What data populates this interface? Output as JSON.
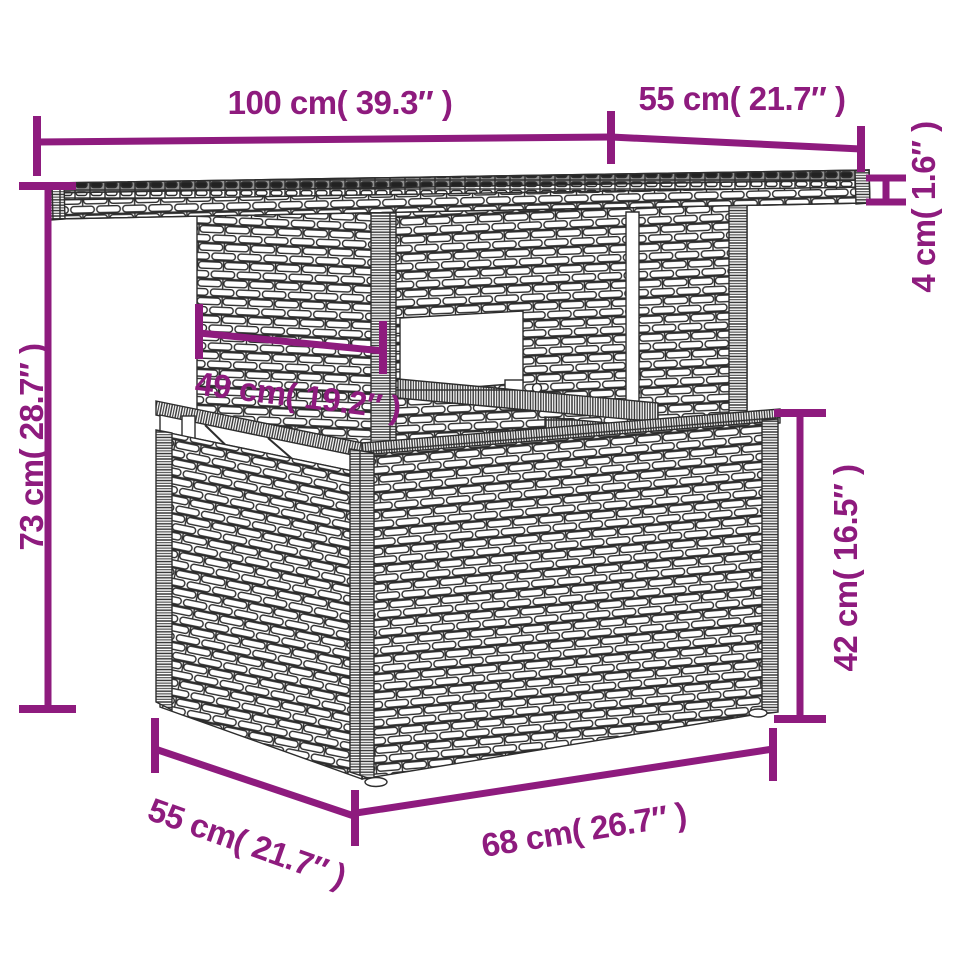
{
  "colors": {
    "dimension": "#8E1B7E",
    "outline": "#2D2D2D",
    "glass_top": "#8F8F8F"
  },
  "labels": {
    "top_width": "100 cm( 39.3″ )",
    "top_depth": "55 cm( 21.7″ )",
    "top_thickness": "4 cm( 1.6″ )",
    "total_height": "73 cm( 28.7″ )",
    "understructure_width": "49 cm( 19.2″ )",
    "base_height": "42 cm( 16.5″ )",
    "base_depth": "55 cm( 21.7″ )",
    "base_width": "68 cm( 26.7″ )"
  }
}
